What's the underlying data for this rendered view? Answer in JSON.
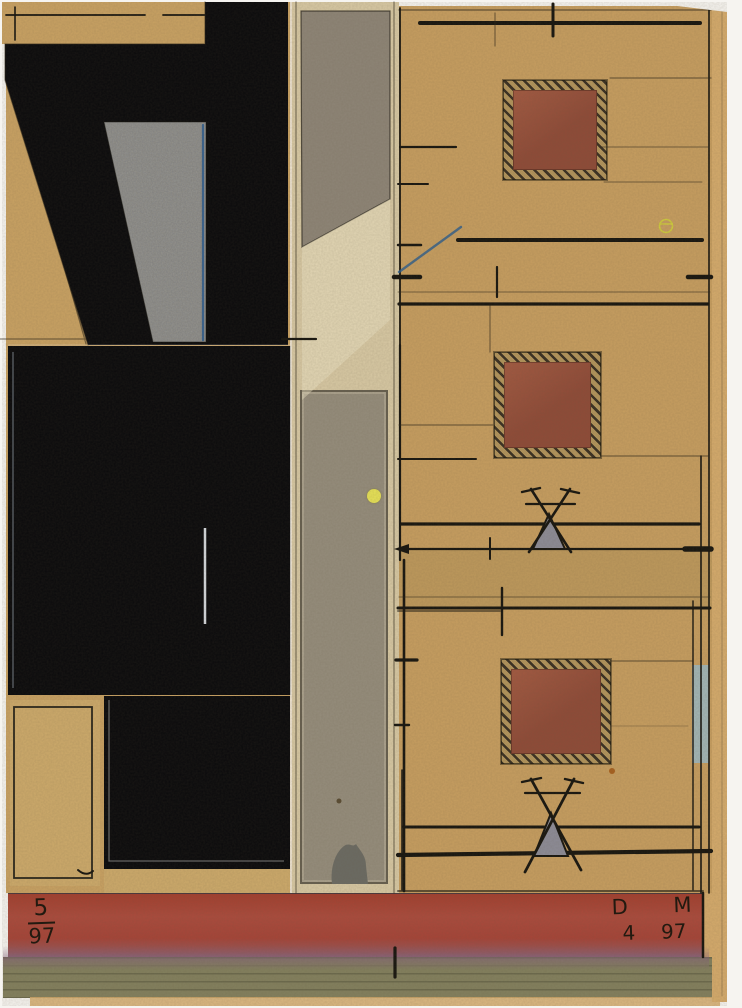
{
  "artwork": {
    "kind": "mixed-media architectural collage study",
    "inscriptions": {
      "edition": {
        "numerator": "5",
        "denominator": "97"
      },
      "signature": {
        "initial_1": "D",
        "initial_2": "M",
        "month": "4",
        "year": "97"
      }
    },
    "palette": {
      "background": "#f6f4f0",
      "kraft_tan": "#c9a263",
      "card_tan": "#cdaa6b",
      "panel_tan": "#c79e60",
      "paper_edge": "#d5ab6c",
      "cream_strip": "#d8c9a4",
      "ink_black": "#17150f",
      "pencil_gray": "rgba(45,38,26,0.55)",
      "glossy_black": "#0a0a0c",
      "speckled_gray": "#999891",
      "column_gray": "#958d7c",
      "quad_gray": "#8e8577",
      "window_brown": "#8f4b38",
      "window_brown_light": "#a35a42",
      "window_frame_gold": "#b3955c",
      "frame_hatch_dark": "#3a3022",
      "band_red": "#a64438",
      "olive_strip": "#83805e",
      "accent_blue": "#2b5c8f",
      "pale_blue": "#a2b6b6",
      "accent_yellow": "#e7e257",
      "marker_gray": "#8d8c97",
      "blob_gray": "#6b6b63"
    }
  }
}
